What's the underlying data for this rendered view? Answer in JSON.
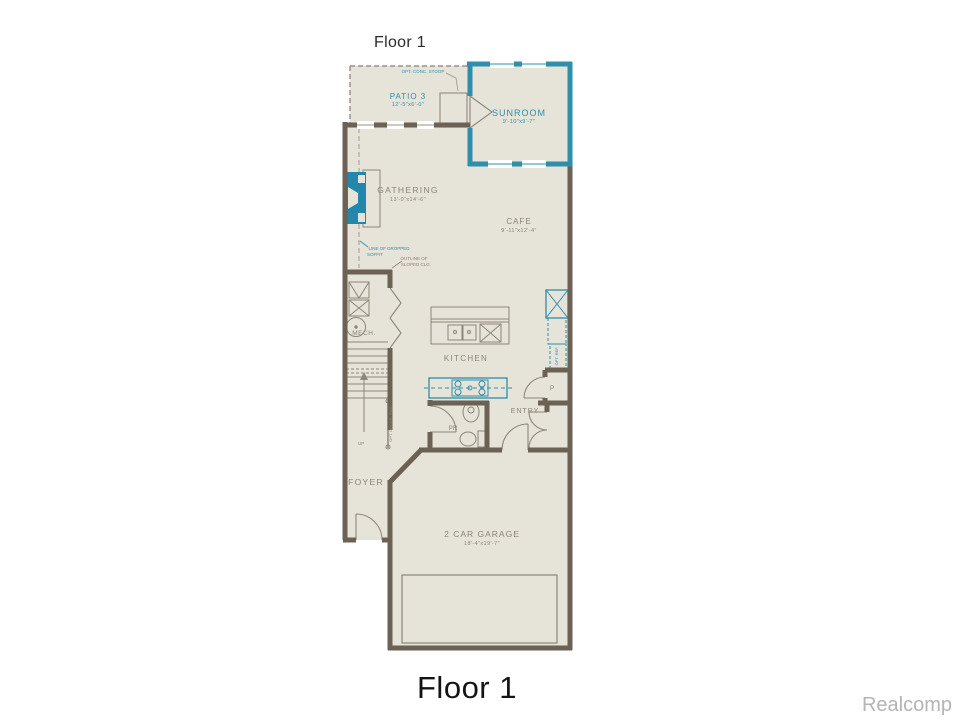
{
  "titles": {
    "top": "Floor 1",
    "bottom": "Floor 1",
    "watermark": "Realcomp"
  },
  "colors": {
    "wall": "#6b6154",
    "accent_teal": "#2e8fad",
    "floor": "#e6e3d8",
    "thin_line": "#8d867a",
    "label_gray": "#8c8477"
  },
  "rooms": {
    "patio": {
      "name": "PATIO 3",
      "dims": "12'-5\"x6'-0\""
    },
    "sunroom": {
      "name": "SUNROOM",
      "dims": "9'-10\"x9'-7\""
    },
    "gathering": {
      "name": "GATHERING",
      "dims": "13'-0\"x14'-6\""
    },
    "cafe": {
      "name": "CAFE",
      "dims": "9'-11\"x12'-4\""
    },
    "kitchen": {
      "name": "KITCHEN"
    },
    "mech": {
      "name": "MECH."
    },
    "pr": {
      "name": "PR"
    },
    "entry": {
      "name": "ENTRY"
    },
    "pantry": {
      "name": "P"
    },
    "foyer": {
      "name": "FOYER"
    },
    "garage": {
      "name": "2 CAR GARAGE",
      "dims": "18'-4\"x19'-7\""
    }
  },
  "annotations": {
    "stoop": "OPT. CONC. STOOP",
    "soffit1": "LINE OF DROPPED",
    "soffit2": "SOFFIT",
    "sloped1": "OUTLINE OF",
    "sloped2": "SLOPED CLG.",
    "opt_ref": "OPT. REF.",
    "rail": "OPT. DECOR. RAIL",
    "up": "UP"
  }
}
